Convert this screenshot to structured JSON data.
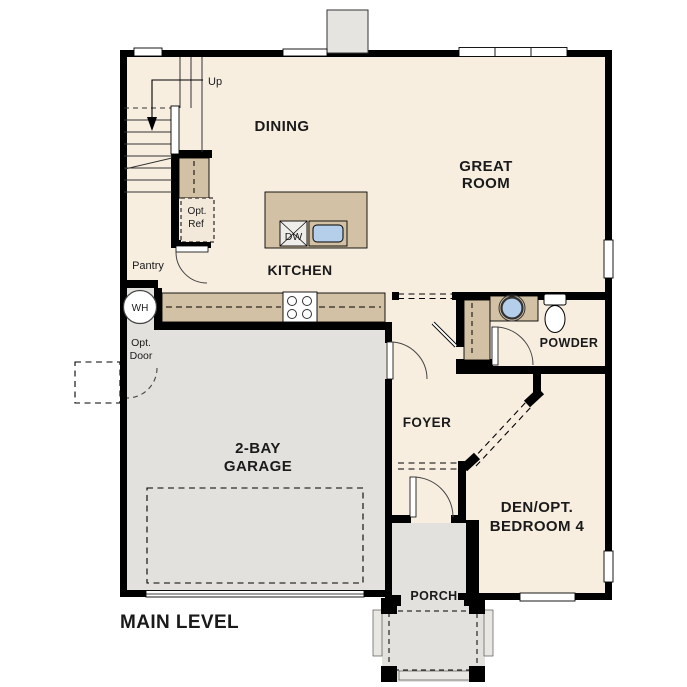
{
  "title": "MAIN LEVEL",
  "colors": {
    "floor": "#f7eee0",
    "garage": "#e3e1dd",
    "wall": "#000000",
    "counter": "#d2c1a4",
    "sink": "#b5cfea",
    "text": "#1a1a1a"
  },
  "rooms": {
    "dining": {
      "label": "DINING"
    },
    "great_room": {
      "line1": "GREAT",
      "line2": "ROOM"
    },
    "kitchen": {
      "label": "KITCHEN"
    },
    "pantry": {
      "label": "Pantry"
    },
    "foyer": {
      "label": "FOYER"
    },
    "powder": {
      "label": "POWDER"
    },
    "garage": {
      "line1": "2-BAY",
      "line2": "GARAGE"
    },
    "den": {
      "line1": "DEN/OPT.",
      "line2": "BEDROOM 4"
    },
    "porch": {
      "label": "PORCH"
    }
  },
  "annotations": {
    "stairs_up": "Up",
    "opt_ref_line1": "Opt.",
    "opt_ref_line2": "Ref",
    "opt_door_line1": "Opt.",
    "opt_door_line2": "Door",
    "water_heater": "WH",
    "dishwasher": "DW"
  }
}
